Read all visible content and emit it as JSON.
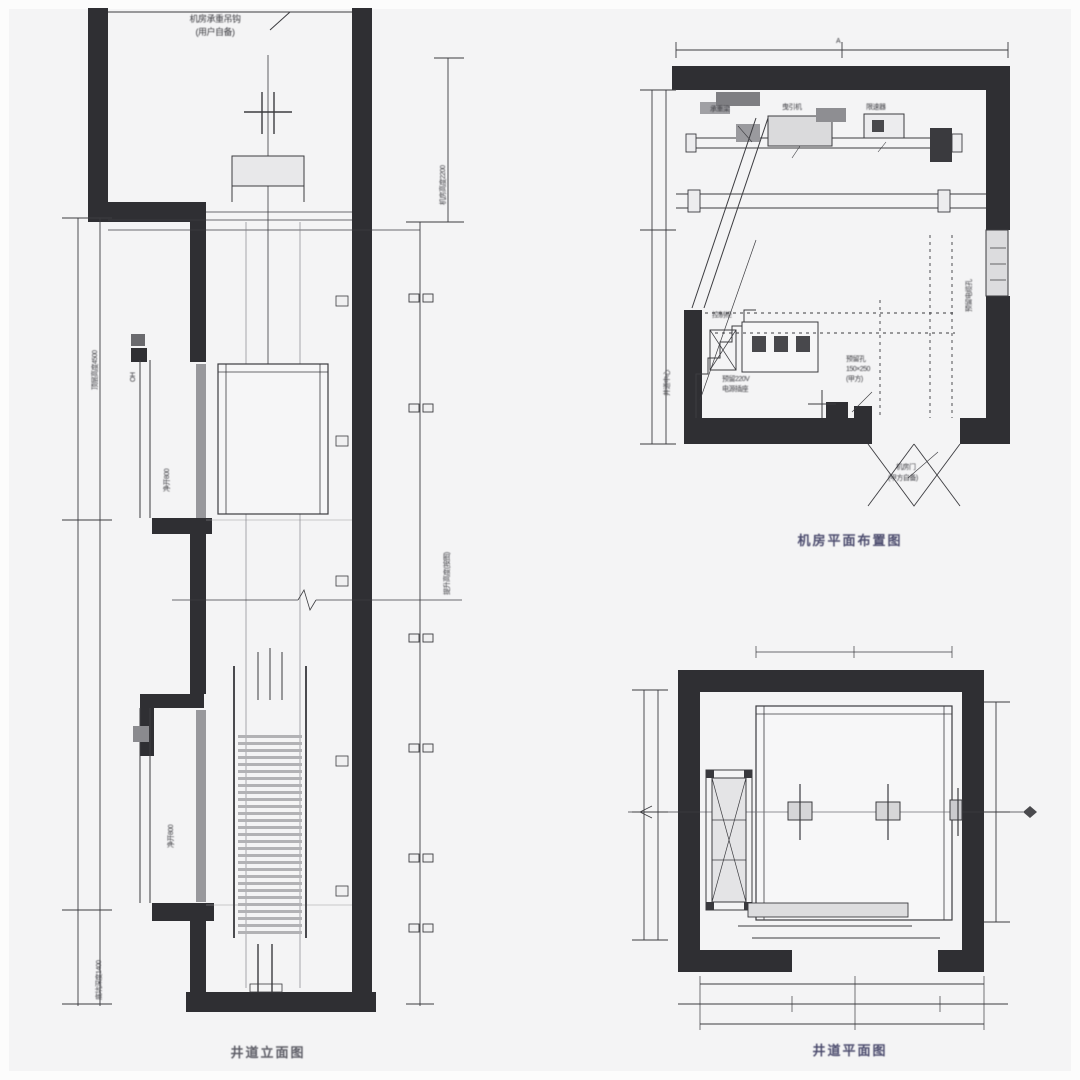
{
  "meta": {
    "background_color": "#f4f4f5",
    "line_color": "#3c3c40",
    "wall_color": "#2f2f33",
    "caption_color_blue": "#4c4c6e",
    "caption_color_gray": "#5d5d66"
  },
  "elevation": {
    "caption": "井道立面图",
    "hook_label": {
      "line1": "机房承重吊钩",
      "line2": "(用户自备)"
    },
    "dim_labels": {
      "machine_room_height": "机房高度2200",
      "top_floor": "顶层高度4500",
      "top_floor_small": "OH",
      "travel": "提升高度(按图)",
      "upper_door": "净开800",
      "lower_door": "净开800",
      "pit_depth": "底坑深度1400"
    }
  },
  "machine_room_plan": {
    "caption": "机房平面布置图",
    "labels": {
      "top_dim": "A",
      "beam": "承重梁",
      "machine": "曳引机",
      "governor": "限速器",
      "cable_hole": "预留电缆孔",
      "left_axis": "井道中心",
      "cabinet": "控制柜",
      "socket_line1": "预留220V",
      "socket_line2": "电源插座",
      "hole_line1": "预留孔",
      "hole_line2": "150×250",
      "hole_line3": "(甲方)",
      "door_line1": "机房门",
      "door_line2": "(甲方自备)"
    }
  },
  "shaft_plan": {
    "caption": "井道平面图"
  }
}
